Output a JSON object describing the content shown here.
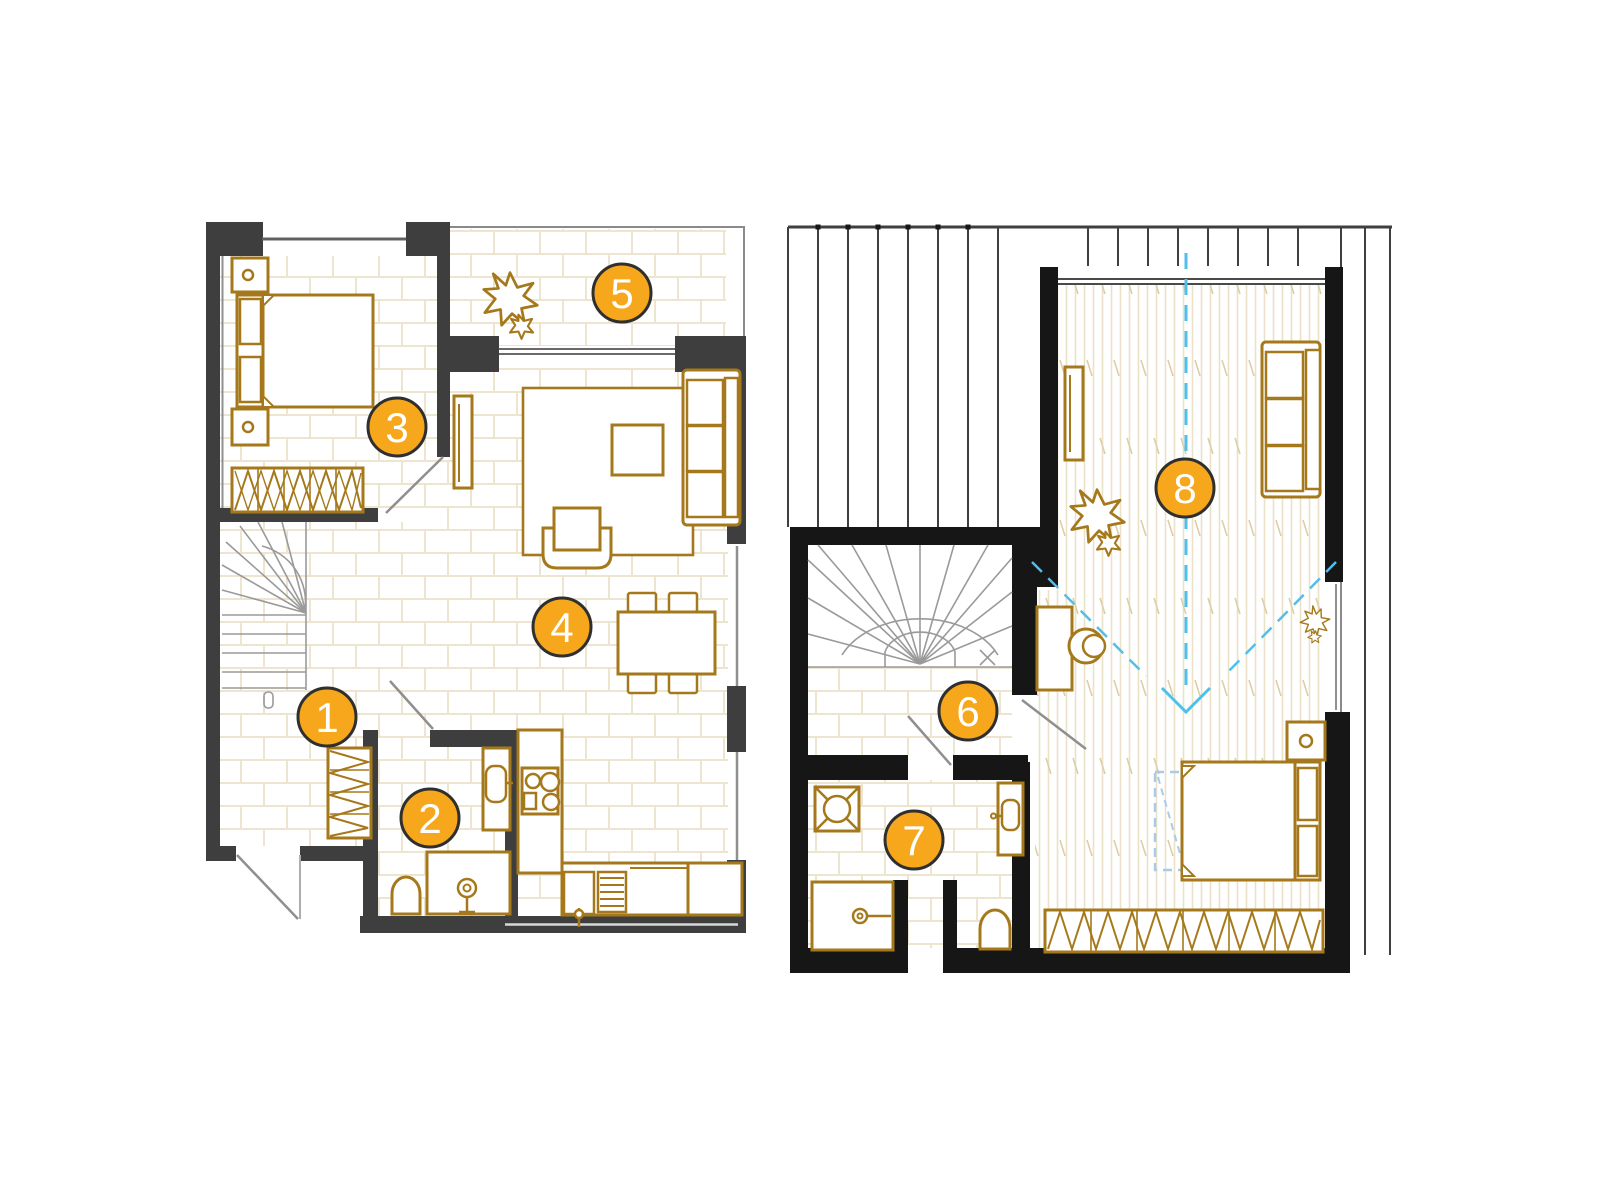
{
  "document": {
    "kind": "floor-plan",
    "levels": 2,
    "visible_text": [
      "1",
      "2",
      "3",
      "4",
      "5",
      "6",
      "7",
      "8"
    ]
  },
  "colors": {
    "background": "#ffffff",
    "wall_dark_gray": "#3e3e3e",
    "wall_black": "#161616",
    "furniture_brown": "#a5791b",
    "floor_brick_line": "#ede5cf",
    "floor_wood_line": "#eae1c7",
    "stair_line": "#9a9a9a",
    "door_line": "#8f8f8f",
    "roof_line": "#3f3f3f",
    "guide_blue": "#4fc0ee",
    "skylight_blue": "#a9cbea",
    "marker_fill": "#f6a71b",
    "marker_ring": "#2f2f2f",
    "marker_text": "#ffffff"
  },
  "markers": [
    {
      "label": "1"
    },
    {
      "label": "2"
    },
    {
      "label": "3"
    },
    {
      "label": "4"
    },
    {
      "label": "5"
    },
    {
      "label": "6"
    },
    {
      "label": "7"
    },
    {
      "label": "8"
    }
  ]
}
